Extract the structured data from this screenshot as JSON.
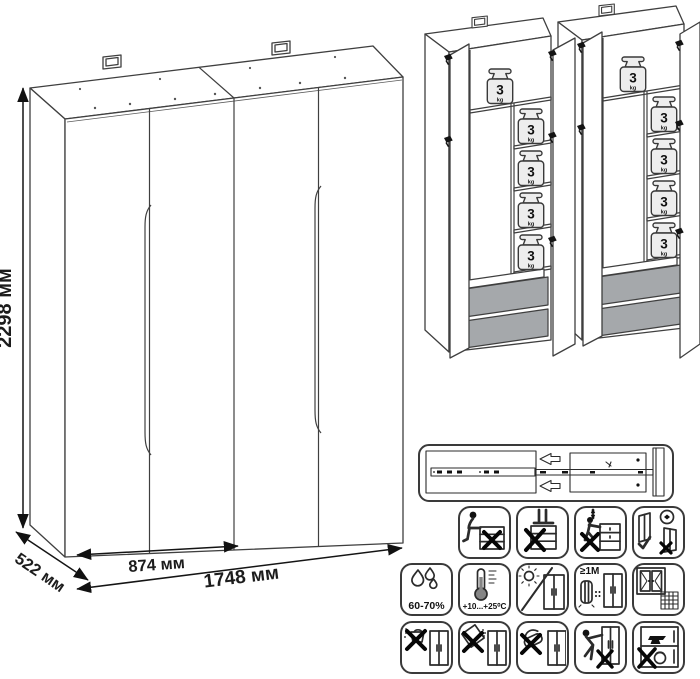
{
  "drawing": {
    "dimensions": {
      "height": "2298 мм",
      "depth": "522 мм",
      "module_width": "874 мм",
      "total_width": "1748 мм"
    },
    "shelf_load": {
      "value": "3",
      "unit": "kg"
    }
  },
  "care_panel": {
    "slide": {
      "name": "drawer-slide-mechanism"
    },
    "rows": [
      {
        "icons": [
          {
            "name": "no-sitting"
          },
          {
            "name": "no-standing"
          },
          {
            "name": "no-climbing"
          },
          {
            "name": "anchor-to-wall"
          }
        ]
      },
      {
        "icons": [
          {
            "name": "humidity-range",
            "label": "60-70%"
          },
          {
            "name": "temperature-range",
            "label": "+10...+25⁰C"
          },
          {
            "name": "no-direct-sunlight"
          },
          {
            "name": "distance-from-heat-sources",
            "label": "≥1M"
          },
          {
            "name": "ventilate-room"
          }
        ]
      },
      {
        "icons": [
          {
            "name": "no-water-cleaning"
          },
          {
            "name": "no-spilling-liquids"
          },
          {
            "name": "no-abrasive-cleaning"
          },
          {
            "name": "no-dragging"
          },
          {
            "name": "no-heavy-objects-inside"
          }
        ]
      }
    ]
  }
}
